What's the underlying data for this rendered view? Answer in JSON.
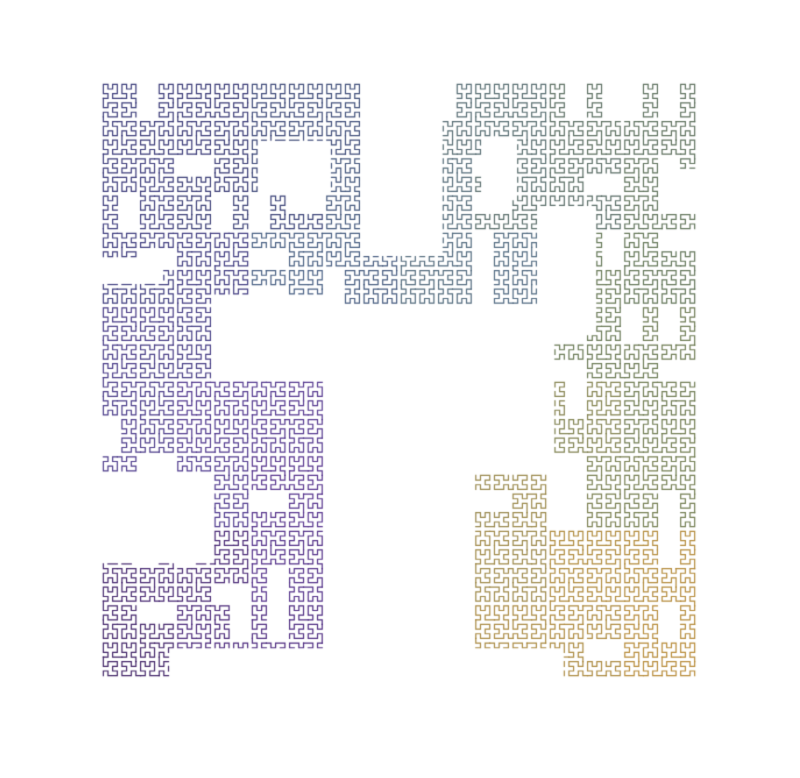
{
  "page": {
    "background": "#ffffff",
    "top_bar": {
      "color": "#0c0c11",
      "height_px": 4
    }
  },
  "canvas": {
    "width": 800,
    "height": 778
  },
  "fractal": {
    "kind": "hilbert-space-filling-curve",
    "order": 7,
    "grid": 128,
    "square": {
      "x": 101,
      "y": 82,
      "size": 596
    },
    "line_width": 1.2,
    "opacity": 0.95,
    "palette": [
      {
        "t": 0.0,
        "color": "#38195f"
      },
      {
        "t": 0.07,
        "color": "#45217a"
      },
      {
        "t": 0.15,
        "color": "#502b8b"
      },
      {
        "t": 0.22,
        "color": "#473289"
      },
      {
        "t": 0.3,
        "color": "#37357a"
      },
      {
        "t": 0.36,
        "color": "#2f316f"
      },
      {
        "t": 0.43,
        "color": "#3b5076"
      },
      {
        "t": 0.49,
        "color": "#446084"
      },
      {
        "t": 0.56,
        "color": "#4c6577"
      },
      {
        "t": 0.63,
        "color": "#526660"
      },
      {
        "t": 0.7,
        "color": "#5d7150"
      },
      {
        "t": 0.77,
        "color": "#6d784a"
      },
      {
        "t": 0.84,
        "color": "#8c8146"
      },
      {
        "t": 0.91,
        "color": "#a2853c"
      },
      {
        "t": 1.0,
        "color": "#b5862e"
      }
    ],
    "mask": {
      "off_rects": [
        [
          0.378,
          0.375,
          0.625,
          1.03
        ],
        [
          0.44,
          -0.02,
          0.567,
          0.287
        ],
        [
          0.625,
          0.375,
          0.755,
          0.655
        ],
        [
          -0.02,
          0.655,
          0.19,
          0.805
        ],
        [
          0.19,
          0.36,
          0.38,
          0.5
        ],
        [
          0.267,
          0.1,
          0.379,
          0.185
        ],
        [
          0.0,
          0.3,
          0.1,
          0.335
        ],
        [
          0.115,
          0.955,
          0.39,
          1.03
        ],
        [
          0.94,
          0.147,
          1.02,
          0.215
        ],
        [
          0.64,
          0.097,
          0.695,
          0.198
        ],
        [
          0.735,
          0.21,
          0.825,
          0.42
        ],
        [
          0.625,
          0.955,
          0.77,
          1.03
        ]
      ],
      "noise": {
        "coarse_block": 128,
        "coarse_p": 0.07,
        "fine_block": 32,
        "fine_p": 0.1,
        "seed": 7
      }
    }
  }
}
